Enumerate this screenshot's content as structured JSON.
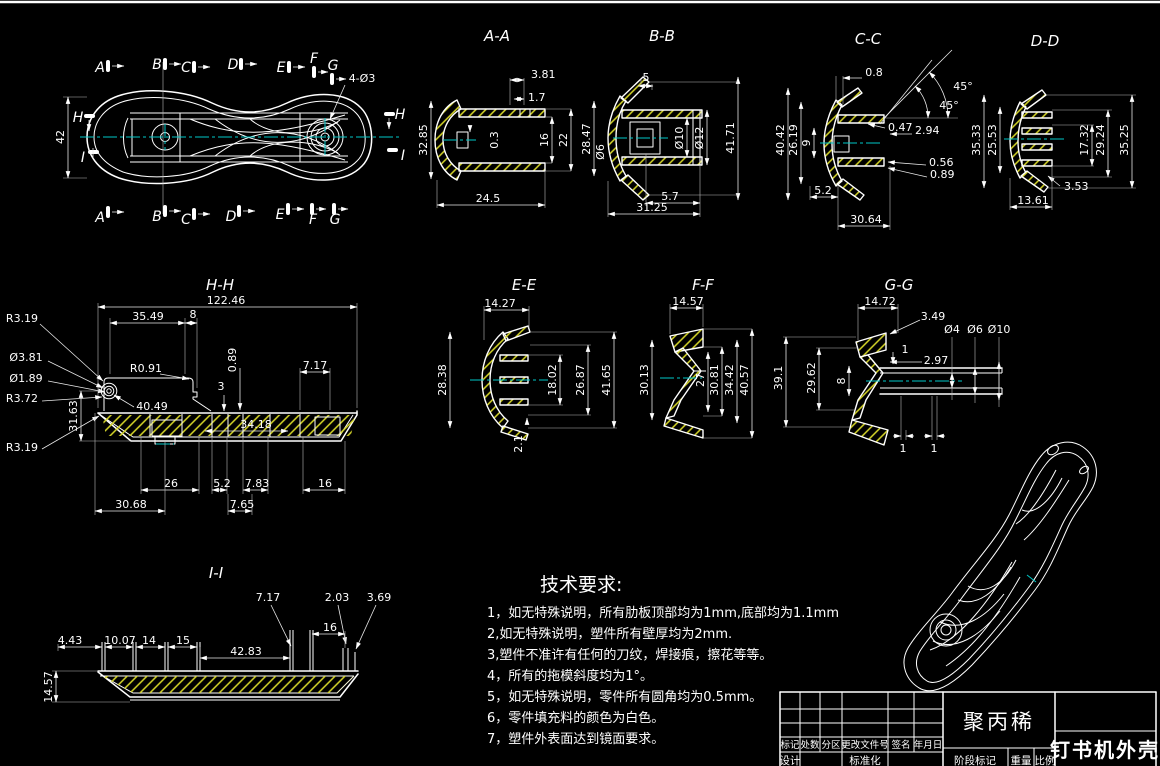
{
  "colors": {
    "background": "#000000",
    "line": "#ffffff",
    "centerline": "#00c8c8",
    "hatch": "#d9d92a"
  },
  "plan": {
    "sections": [
      "A",
      "B",
      "C",
      "D",
      "E",
      "F",
      "G"
    ],
    "h": "H",
    "i": "I",
    "height": "42",
    "holes": "4-Ø3"
  },
  "views": {
    "aa": {
      "label": "A-A",
      "dims": [
        "3.81",
        "1.7",
        "32.85",
        "0.3",
        "16",
        "22",
        "24.5"
      ]
    },
    "bb": {
      "label": "B-B",
      "dims": [
        "5",
        "28.47",
        "Ø6",
        "Ø10",
        "Ø12",
        "41.71",
        "5.7",
        "31.25"
      ]
    },
    "cc": {
      "label": "C-C",
      "dims": [
        "0.8",
        "45°",
        "45°",
        "0.47",
        "2.94",
        "0.56",
        "0.89",
        "40.42",
        "26.19",
        "9",
        "5.2",
        "30.64"
      ]
    },
    "dd": {
      "label": "D-D",
      "dims": [
        "35.33",
        "25.53",
        "17.32",
        "29.24",
        "35.25",
        "3.53",
        "13.61"
      ]
    },
    "hh": {
      "label": "H-H",
      "dims": [
        "122.46",
        "35.49",
        "8",
        "R3.19",
        "Ø3.81",
        "Ø1.89",
        "R3.72",
        "R3.19",
        "R0.91",
        "40.49",
        "0.89",
        "3",
        "7.17",
        "31.63",
        "34.18",
        "26",
        "5.2",
        "7.83",
        "16",
        "30.68",
        "7.65"
      ]
    },
    "ee": {
      "label": "E-E",
      "dims": [
        "14.27",
        "28.38",
        "18.02",
        "26.87",
        "41.65",
        "2.1"
      ]
    },
    "ff": {
      "label": "F-F",
      "dims": [
        "14.57",
        "30.13",
        "27",
        "30.81",
        "34.42",
        "40.57"
      ]
    },
    "gg": {
      "label": "G-G",
      "dims": [
        "14.72",
        "3.49",
        "Ø4",
        "Ø6",
        "Ø10",
        "1",
        "2.97",
        "8",
        "39.1",
        "29.62",
        "1",
        "1"
      ]
    },
    "ii": {
      "label": "I-I",
      "dims": [
        "7.17",
        "2.03",
        "3.69",
        "16",
        "4.43",
        "10.07",
        "14",
        "15",
        "42.83",
        "14.57"
      ]
    }
  },
  "tech": {
    "title": "技术要求:",
    "items": [
      "1，如无特殊说明，所有肋板顶部均为1mm,底部均为1.1mm",
      "2,如无特殊说明，塑件所有壁厚均为2mm.",
      "3,塑件不准许有任何的刀纹，焊接痕，擦花等等。",
      "4，所有的拖模斜度均为1°。",
      "5，如无特殊说明，零件所有圆角均为0.5mm。",
      "6，零件填充料的颜色为白色。",
      "7，塑件外表面达到镜面要求。"
    ]
  },
  "title_block": {
    "material": "聚丙稀",
    "part_name": "钉书机外壳",
    "cols": [
      "标记",
      "处数",
      "分区",
      "更改文件号",
      "签名",
      "年月日"
    ],
    "design": "设计",
    "standard": "标准化",
    "stage": [
      "阶段标记",
      "重量",
      "比例"
    ]
  }
}
